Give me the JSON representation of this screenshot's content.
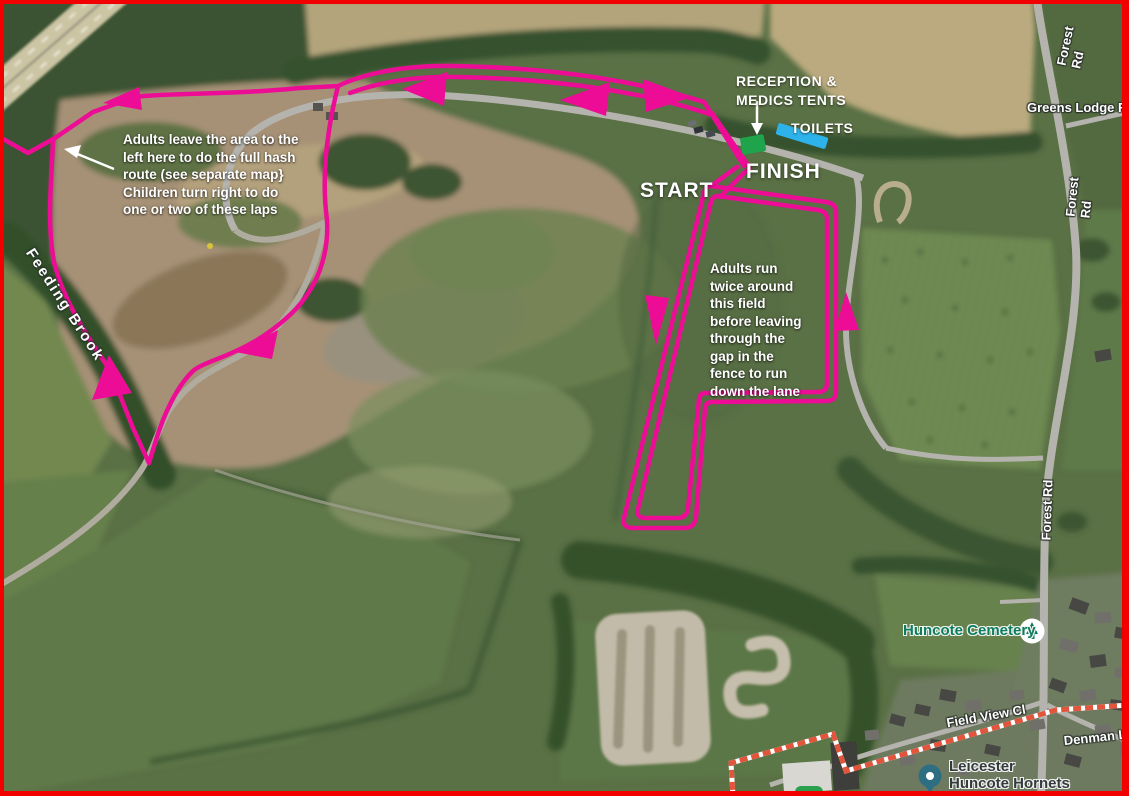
{
  "map": {
    "route_notes": {
      "adults_leave": "Adults leave the area to the\nleft here to do the full hash\nroute (see separate map}\nChildren turn right to do\none or two of these laps",
      "adults_run": "Adults run\ntwice around\nthis field\nbefore leaving\nthrough the\ngap in the\nfence to run\ndown the lane",
      "reception": "RECEPTION &\nMEDICS TENTS",
      "toilets": "TOILETS",
      "start": "START",
      "finish": "FINISH"
    },
    "place_labels": {
      "feeding_brook": "Feeding Brook",
      "greens_lodge_farm": "Greens Lodge Farm",
      "forest_rd": "Forest Rd",
      "huncote_cemetery": "Huncote Cemetery",
      "field_view_cl": "Field View Cl",
      "denman_ln": "Denman Ln",
      "hornets_line1": "Leicester",
      "hornets_line2": "Huncote Hornets"
    },
    "colors": {
      "route": "#EC0C95",
      "reception_tent_marker": "#1FA44B",
      "toilets_marker": "#2DB3EA",
      "screenshot_border": "#F20000",
      "boundary_dash": "#E2543C",
      "poi_teal": "#0E7C60"
    }
  }
}
